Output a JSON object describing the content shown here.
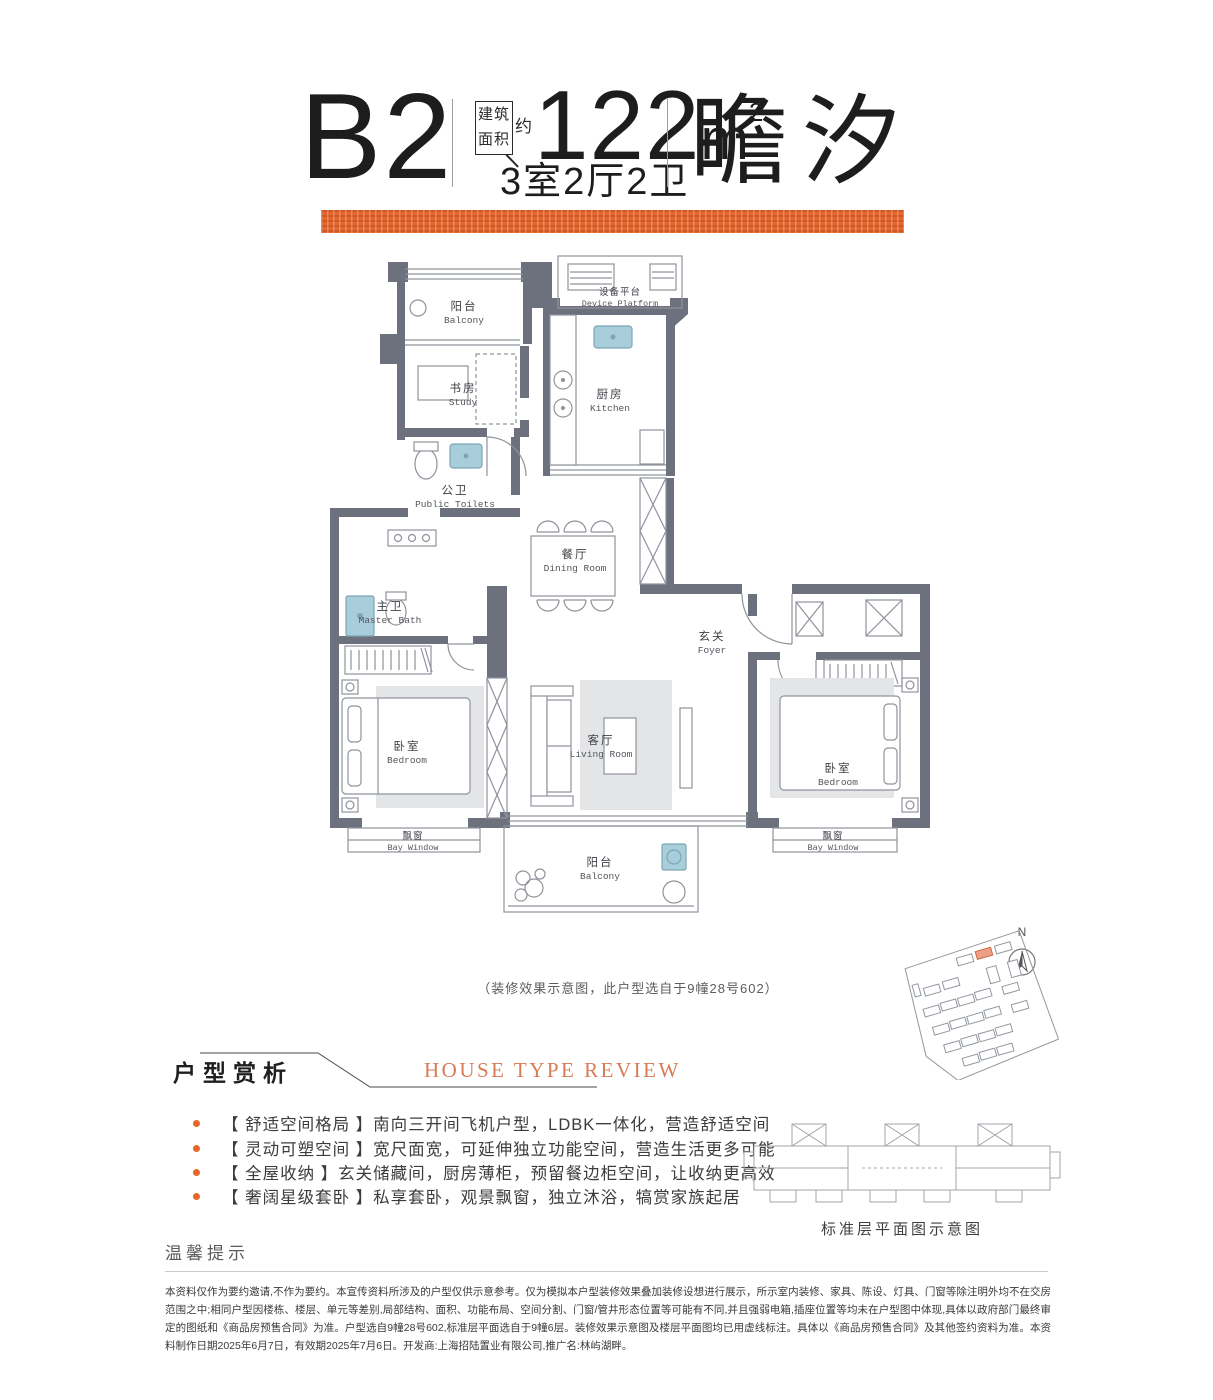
{
  "header": {
    "unit_code": "B2",
    "area_box_line1": "建筑",
    "area_box_line2": "面积",
    "approx_label": "约",
    "area_value": "122",
    "area_unit": "m",
    "area_unit_sup": "2",
    "layout_label": "3室2厅2卫",
    "product_name": "瞻汐"
  },
  "plan": {
    "caption": "（装修效果示意图，此户型选自于9幢28号602）",
    "compass_label": "N",
    "rooms": {
      "balcony_top": {
        "zh": "阳台",
        "en": "Balcony"
      },
      "device_platform": {
        "zh": "设备平台",
        "en": "Device Platform"
      },
      "study": {
        "zh": "书房",
        "en": "Study"
      },
      "kitchen": {
        "zh": "厨房",
        "en": "Kitchen"
      },
      "public_toilet": {
        "zh": "公卫",
        "en": "Public Toilets"
      },
      "dining": {
        "zh": "餐厅",
        "en": "Dining Room"
      },
      "master_bath": {
        "zh": "主卫",
        "en": "Master Bath"
      },
      "foyer": {
        "zh": "玄关",
        "en": "Foyer"
      },
      "bedroom_left": {
        "zh": "卧室",
        "en": "Bedroom"
      },
      "living": {
        "zh": "客厅",
        "en": "Living Room"
      },
      "bedroom_right": {
        "zh": "卧室",
        "en": "Bedroom"
      },
      "bay_window_left": {
        "zh": "飘窗",
        "en": "Bay Window"
      },
      "bay_window_right": {
        "zh": "飘窗",
        "en": "Bay Window"
      },
      "balcony_bottom": {
        "zh": "阳台",
        "en": "Balcony"
      }
    }
  },
  "review": {
    "title_zh": "户型赏析",
    "title_en": "HOUSE TYPE REVIEW",
    "bullets": [
      "【 舒适空间格局 】南向三开间飞机户型，LDBK一体化，营造舒适空间",
      "【 灵动可塑空间 】宽尺面宽，可延伸独立功能空间，营造生活更多可能",
      "【 全屋收纳 】玄关储藏间，厨房薄柜，预留餐边柜空间，让收纳更高效",
      "【 奢阔星级套卧 】私享套卧，观景飘窗，独立沐浴，犒赏家族起居"
    ]
  },
  "standard_floor": {
    "caption": "标准层平面图示意图"
  },
  "notice": {
    "title": "温馨提示",
    "disclaimer": "本资料仅作为要约邀请,不作为要约。本宣传资料所涉及的户型仅供示意参考。仅为模拟本户型装修效果叠加装修设想进行展示，所示室内装修、家具、陈设、灯具、门窗等除注明外均不在交房范围之中;相同户型因楼栋、楼层、单元等差别,局部结构、面积、功能布局、空间分割、门窗/管井形态位置等可能有不同,并且强弱电箱,插座位置等均未在户型图中体现,具体以政府部门最终审定的图纸和《商品房预售合同》为准。户型选自9幢28号602,标准层平面选自于9幢6层。装修效果示意图及楼层平面图均已用虚线标注。具体以《商品房预售合同》及其他签约资料为准。本资料制作日期2025年6月7日，有效期2025年7月6日。开发商:上海招陆置业有限公司,推广名:林屿湖畔。"
  },
  "colors": {
    "accent_orange": "#e4672e",
    "review_title_orange": "#d97b55",
    "wall_gray": "#6d717d",
    "fixture_blue": "#a9cedb"
  }
}
